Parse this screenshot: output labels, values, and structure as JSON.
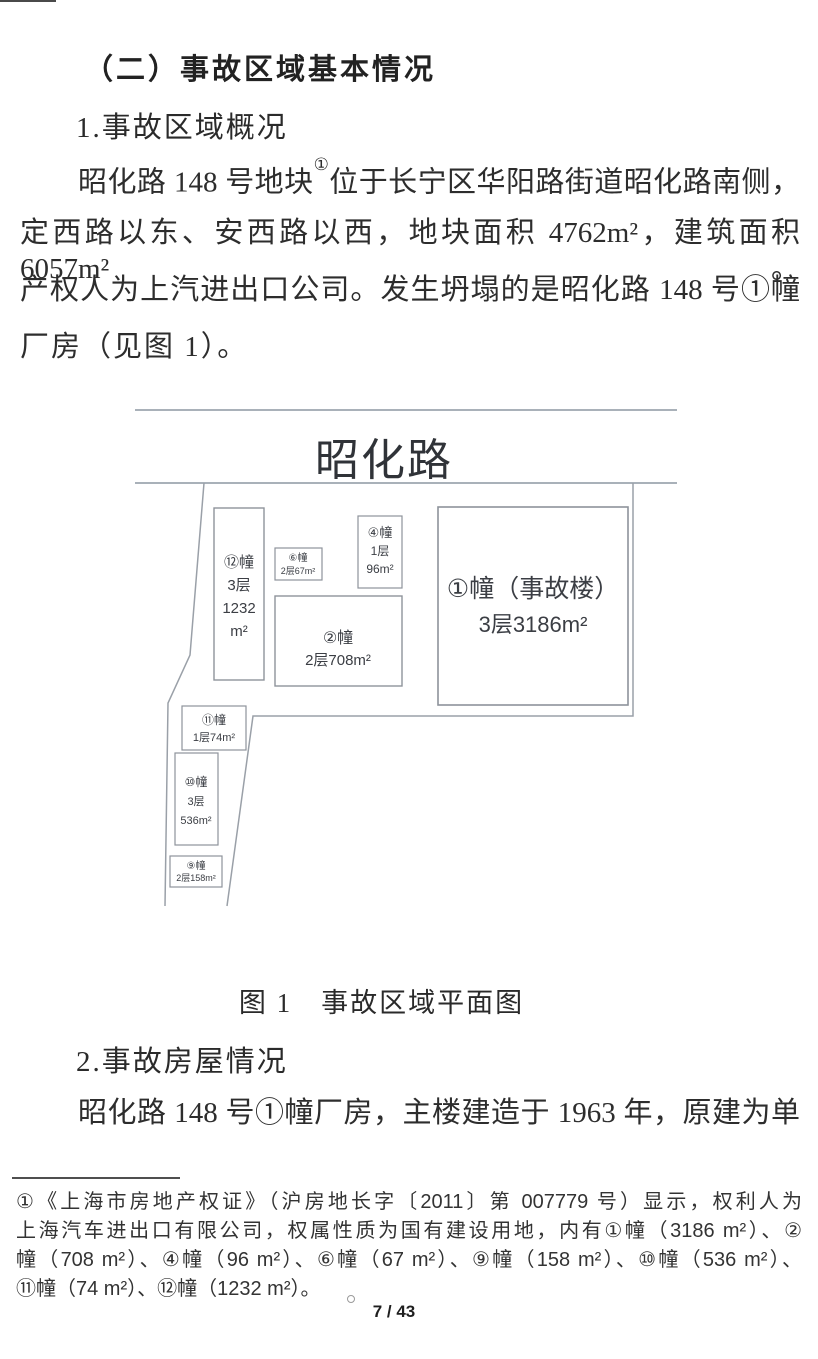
{
  "colors": {
    "page_bg": "#ffffff",
    "text": "#2d2d2d",
    "figure_line": "#a9b1b9",
    "building_border": "#8e939b"
  },
  "heading": {
    "section": "（二）事故区域基本情况"
  },
  "body": {
    "sub1": "1.事故区域概况",
    "p1_l1_pre": "昭化路 148 号地块",
    "p1_l1_sup": "①",
    "p1_l1_post": "位于长宁区华阳路街道昭化路南侧，",
    "p1_l2": "定西路以东、安西路以西，地块面积 4762m²，建筑面积 6057m²。",
    "p1_l3": "产权人为上汽进出口公司。发生坍塌的是昭化路 148 号①幢",
    "p1_l4": "厂房（见图 1）。",
    "sub2": "2.事故房屋情况",
    "p2_l1": "昭化路 148 号①幢厂房，主楼建造于 1963 年，原建为单"
  },
  "figure": {
    "road_label": "昭化路",
    "caption": "图 1　事故区域平面图",
    "buildings": [
      {
        "name": "building-12",
        "lines": [
          "⑫幢",
          "3层",
          "1232",
          "m²"
        ]
      },
      {
        "name": "building-6",
        "lines": [
          "⑥幢",
          "2层67m²"
        ]
      },
      {
        "name": "building-4",
        "lines": [
          "④幢",
          "1层",
          "96m²"
        ]
      },
      {
        "name": "building-2",
        "lines": [
          "②幢",
          "2层708m²"
        ]
      },
      {
        "name": "building-1",
        "lines": [
          "①幢（事故楼）",
          "3层3186m²"
        ]
      },
      {
        "name": "building-11",
        "lines": [
          "⑪幢",
          "1层74m²"
        ]
      },
      {
        "name": "building-10",
        "lines": [
          "⑩幢",
          "3层",
          "536m²"
        ]
      },
      {
        "name": "building-9",
        "lines": [
          "⑨幢",
          "2层158m²"
        ]
      }
    ]
  },
  "footnote": {
    "l1": "①《上海市房地产权证》（沪房地长字〔2011〕第 007779 号）显示，权利人为",
    "l2": "上海汽车进出口有限公司，权属性质为国有建设用地，内有①幢（3186 m²）、②",
    "l3": "幢（708 m²）、④幢（96 m²）、⑥幢（67 m²）、⑨幢（158 m²）、⑩幢（536 m²）、",
    "l4": "⑪幢（74 m²）、⑫幢（1232 m²）。"
  },
  "footer": {
    "page_number": "7 / 43"
  }
}
